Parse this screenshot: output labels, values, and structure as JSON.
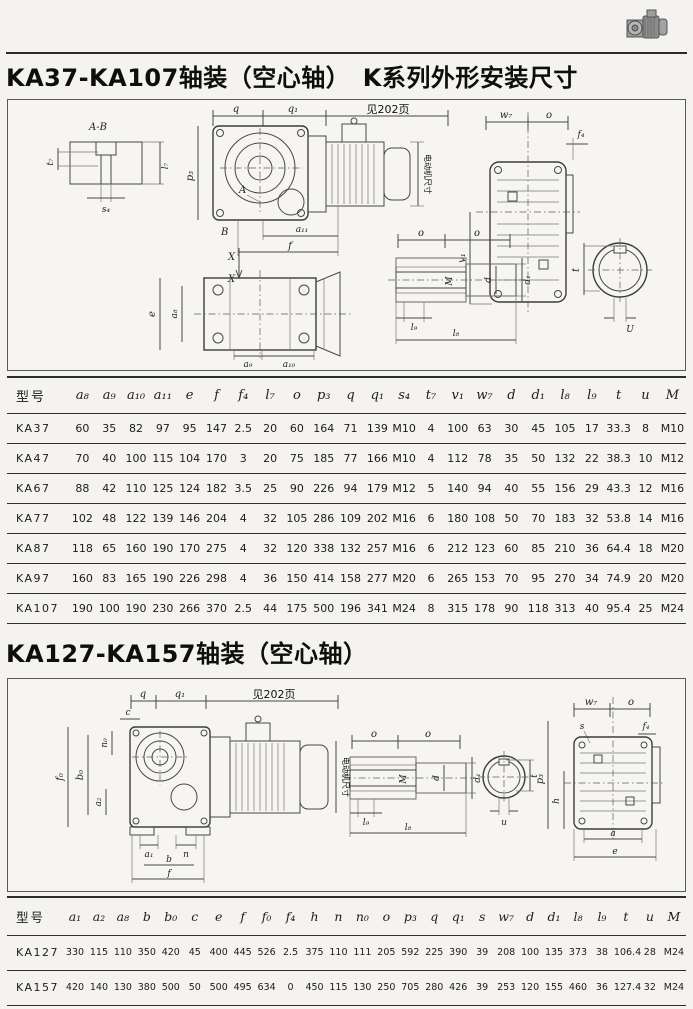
{
  "page": {
    "title1": "KA37-KA107轴装（空心轴）　K系列外形安装尺寸",
    "title2": "KA127-KA157轴装（空心轴）"
  },
  "diagram1": {
    "labels": {
      "ab": "A-B",
      "t7": "t₇",
      "l7": "l₇",
      "s4": "s₄",
      "q": "q",
      "q1": "q₁",
      "see_page": "见202页",
      "p3": "p₃",
      "A": "A",
      "B": "B",
      "a11": "a₁₁",
      "f": "f",
      "X": "X",
      "motor": "电动机尺寸",
      "w7": "w₇",
      "o": "o",
      "f4": "f₄",
      "v1": "v₁",
      "e": "e",
      "a8": "a₈",
      "a9": "a₉",
      "a10": "a₁₀",
      "M": "M",
      "d": "d",
      "d1": "d₁",
      "l8": "l₈",
      "l9": "l₉",
      "t": "t",
      "u_upper": "U"
    }
  },
  "diagram2": {
    "labels": {
      "q": "q",
      "q1": "q₁",
      "see_page": "见202页",
      "c": "c",
      "n0": "n₀",
      "f0": "f₀",
      "b0": "b₀",
      "a2": "a₂",
      "a1": "a₁",
      "n": "n",
      "b": "b",
      "f": "f",
      "motor": "电动机尺寸",
      "o": "o",
      "M": "M",
      "d": "d",
      "d1": "d₁",
      "l8": "l₈",
      "l9": "l₉",
      "t": "t",
      "u": "u",
      "w7": "w₇",
      "s": "s",
      "f4": "f₄",
      "p3": "p₃",
      "h": "h",
      "a": "a",
      "e": "e"
    }
  },
  "table1": {
    "model_header": "型号",
    "columns": [
      "a₈",
      "a₉",
      "a₁₀",
      "a₁₁",
      "e",
      "f",
      "f₄",
      "l₇",
      "o",
      "p₃",
      "q",
      "q₁",
      "s₄",
      "t₇",
      "v₁",
      "w₇",
      "d",
      "d₁",
      "l₈",
      "l₉",
      "t",
      "u",
      "M"
    ],
    "rows": [
      {
        "model": "KA37",
        "values": [
          "60",
          "35",
          "82",
          "97",
          "95",
          "147",
          "2.5",
          "20",
          "60",
          "164",
          "71",
          "139",
          "M10",
          "4",
          "100",
          "63",
          "30",
          "45",
          "105",
          "17",
          "33.3",
          "8",
          "M10"
        ]
      },
      {
        "model": "KA47",
        "values": [
          "70",
          "40",
          "100",
          "115",
          "104",
          "170",
          "3",
          "20",
          "75",
          "185",
          "77",
          "166",
          "M10",
          "4",
          "112",
          "78",
          "35",
          "50",
          "132",
          "22",
          "38.3",
          "10",
          "M12"
        ]
      },
      {
        "model": "KA67",
        "values": [
          "88",
          "42",
          "110",
          "125",
          "124",
          "182",
          "3.5",
          "25",
          "90",
          "226",
          "94",
          "179",
          "M12",
          "5",
          "140",
          "94",
          "40",
          "55",
          "156",
          "29",
          "43.3",
          "12",
          "M16"
        ]
      },
      {
        "model": "KA77",
        "values": [
          "102",
          "48",
          "122",
          "139",
          "146",
          "204",
          "4",
          "32",
          "105",
          "286",
          "109",
          "202",
          "M16",
          "6",
          "180",
          "108",
          "50",
          "70",
          "183",
          "32",
          "53.8",
          "14",
          "M16"
        ]
      },
      {
        "model": "KA87",
        "values": [
          "118",
          "65",
          "160",
          "190",
          "170",
          "275",
          "4",
          "32",
          "120",
          "338",
          "132",
          "257",
          "M16",
          "6",
          "212",
          "123",
          "60",
          "85",
          "210",
          "36",
          "64.4",
          "18",
          "M20"
        ]
      },
      {
        "model": "KA97",
        "values": [
          "160",
          "83",
          "165",
          "190",
          "226",
          "298",
          "4",
          "36",
          "150",
          "414",
          "158",
          "277",
          "M20",
          "6",
          "265",
          "153",
          "70",
          "95",
          "270",
          "34",
          "74.9",
          "20",
          "M20"
        ]
      },
      {
        "model": "KA107",
        "values": [
          "190",
          "100",
          "190",
          "230",
          "266",
          "370",
          "2.5",
          "44",
          "175",
          "500",
          "196",
          "341",
          "M24",
          "8",
          "315",
          "178",
          "90",
          "118",
          "313",
          "40",
          "95.4",
          "25",
          "M24"
        ]
      }
    ]
  },
  "table2": {
    "model_header": "型号",
    "columns": [
      "a₁",
      "a₂",
      "a₈",
      "b",
      "b₀",
      "c",
      "e",
      "f",
      "f₀",
      "f₄",
      "h",
      "n",
      "n₀",
      "o",
      "p₃",
      "q",
      "q₁",
      "s",
      "w₇",
      "d",
      "d₁",
      "l₈",
      "l₉",
      "t",
      "u",
      "M"
    ],
    "rows": [
      {
        "model": "KA127",
        "values": [
          "330",
          "115",
          "110",
          "350",
          "420",
          "45",
          "400",
          "445",
          "526",
          "2.5",
          "375",
          "110",
          "111",
          "205",
          "592",
          "225",
          "390",
          "39",
          "208",
          "100",
          "135",
          "373",
          "38",
          "106.4",
          "28",
          "M24"
        ]
      },
      {
        "model": "KA157",
        "values": [
          "420",
          "140",
          "130",
          "380",
          "500",
          "50",
          "500",
          "495",
          "634",
          "0",
          "450",
          "115",
          "130",
          "250",
          "705",
          "280",
          "426",
          "39",
          "253",
          "120",
          "155",
          "460",
          "36",
          "127.4",
          "32",
          "M24"
        ]
      }
    ]
  }
}
